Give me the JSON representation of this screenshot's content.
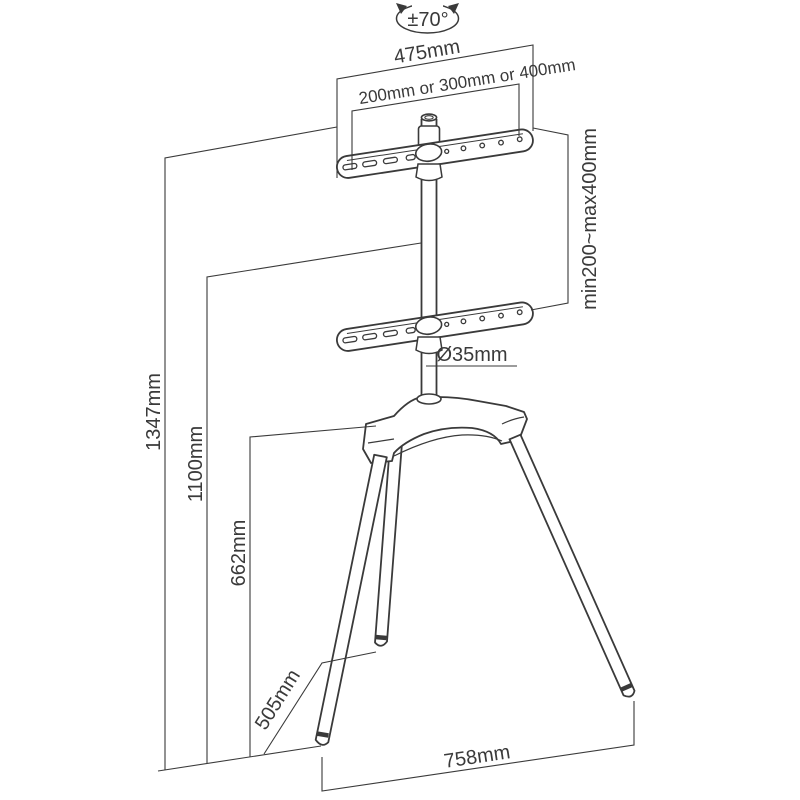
{
  "diagram": {
    "type": "technical-dimension-drawing",
    "subject": "tripod easel TV floor stand with VESA brackets",
    "colors": {
      "line": "#3a3a3a",
      "background": "#ffffff"
    },
    "labels": {
      "rotation": "±70°",
      "top_width": "475mm",
      "vesa_width": "200mm or 300mm or 400mm",
      "vesa_height": "min200~max400mm",
      "total_height": "1347mm",
      "pole_height": "1100mm",
      "hub_height": "662mm",
      "pole_diameter": "Ø35mm",
      "base_depth": "505mm",
      "base_width": "758mm"
    }
  }
}
